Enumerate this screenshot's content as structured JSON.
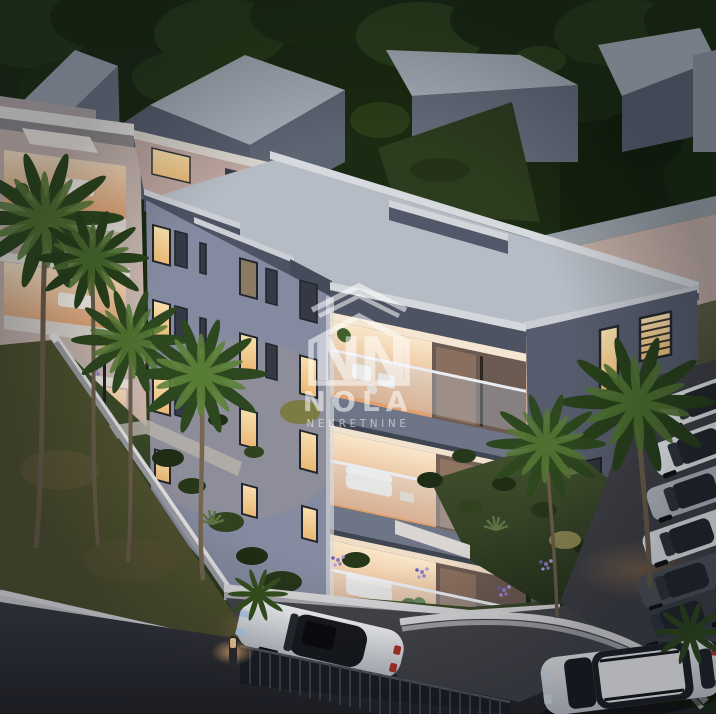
{
  "watermark": {
    "monogram": "NN",
    "name": "NOLA",
    "subtitle": "NEKRETNINE",
    "color": "#ffffff",
    "opacity": "0.55"
  },
  "palette": {
    "trees": "#1b2a12",
    "house_roof": "#a6adb8",
    "house_wall": "#5d6472",
    "distant_house_pink": "#c3aea6",
    "left_building_facade": "#c6b5ae",
    "main_facade_left": "#848ba0",
    "main_facade_right": "#565c6d",
    "main_roof": "#b6bcc5",
    "parapet": "#4d5363",
    "coping": "#d4d7dc",
    "balcony_warm": "#f4ddba",
    "window_lit": "#f6dfae",
    "grass": "#3c4a2b",
    "grass_outer": "#4f512f",
    "wall_white": "#dfdfe2",
    "road": "#34353b",
    "driveway": "#45464c",
    "fence": "#1c1f25",
    "car_white": "#f0f2f5",
    "parked_cars": [
      "#eceff2",
      "#b9bec6",
      "#e8ebee",
      "#4e535b",
      "#3a3e45"
    ],
    "lamp_glow": "#ffc37e",
    "flowers": "#8b7ec9",
    "palm_dark": "#2d471e",
    "palm_light": "#5a7c34"
  }
}
